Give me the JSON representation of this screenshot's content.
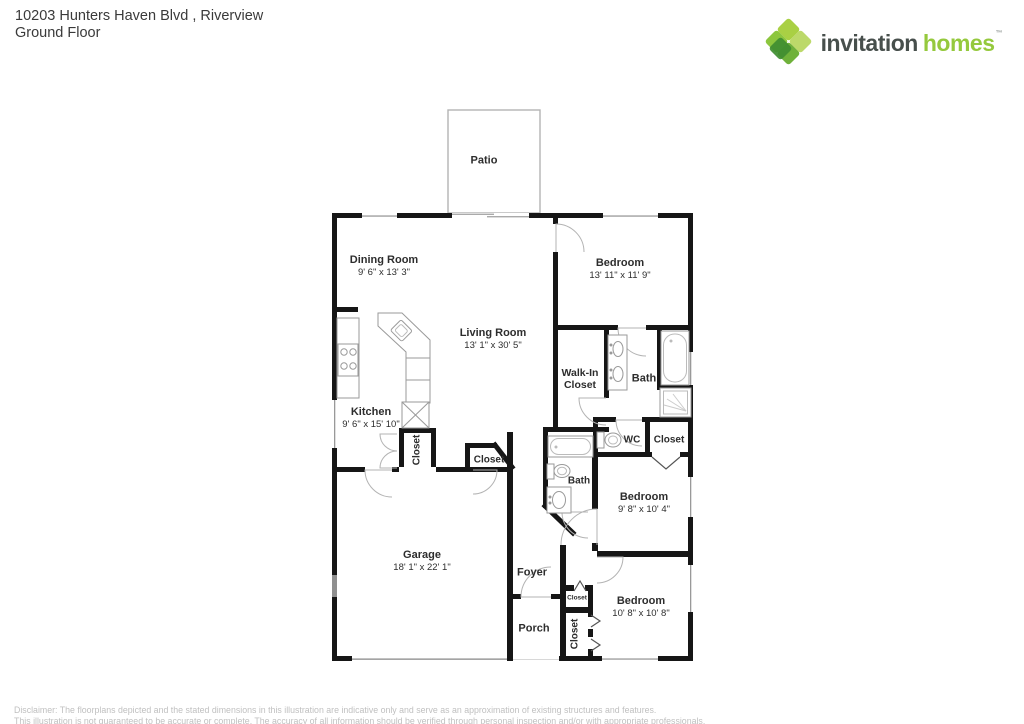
{
  "header": {
    "address": "10203 Hunters Haven Blvd , Riverview",
    "floor_label": "Ground Floor"
  },
  "logo": {
    "part1": "invitation",
    "part2": "homes",
    "tm": "™"
  },
  "rooms": {
    "patio": {
      "name": "Patio"
    },
    "dining": {
      "name": "Dining Room",
      "dims": "9' 6\" x 13' 3\""
    },
    "living": {
      "name": "Living Room",
      "dims": "13' 1\" x 30' 5\""
    },
    "bedroom1": {
      "name": "Bedroom",
      "dims": "13' 11\" x 11' 9\""
    },
    "walkin": {
      "name": "Walk-In Closet"
    },
    "bath1": {
      "name": "Bath"
    },
    "kitchen": {
      "name": "Kitchen",
      "dims": "9' 6\" x 15' 10\""
    },
    "closet_kitchen": {
      "name": "Closet"
    },
    "closet_garage": {
      "name": "Closet"
    },
    "wc": {
      "name": "WC"
    },
    "closet_hall": {
      "name": "Closet"
    },
    "bath2": {
      "name": "Bath"
    },
    "bedroom2": {
      "name": "Bedroom",
      "dims": "9' 8\" x 10' 4\""
    },
    "garage": {
      "name": "Garage",
      "dims": "18' 1\" x 22' 1\""
    },
    "foyer": {
      "name": "Foyer"
    },
    "porch": {
      "name": "Porch"
    },
    "closet_small": {
      "name": "Closet"
    },
    "closet_bedroom3": {
      "name": "Closet"
    },
    "bedroom3": {
      "name": "Bedroom",
      "dims": "10' 8\" x 10' 8\""
    }
  },
  "disclaimer": {
    "line1": "Disclaimer: The floorplans depicted and the stated dimensions in this illustration are indicative only and serve as an approximation of existing structures and features.",
    "line2": "This illustration is not guaranteed to be accurate or complete. The accuracy of all information should be verified through personal inspection and/or with appropriate professionals."
  },
  "colors": {
    "logo_green": "#95c93d",
    "logo_dark": "#474f4c",
    "wall": "#161616",
    "disclaimer_text": "#c0c0c0"
  }
}
